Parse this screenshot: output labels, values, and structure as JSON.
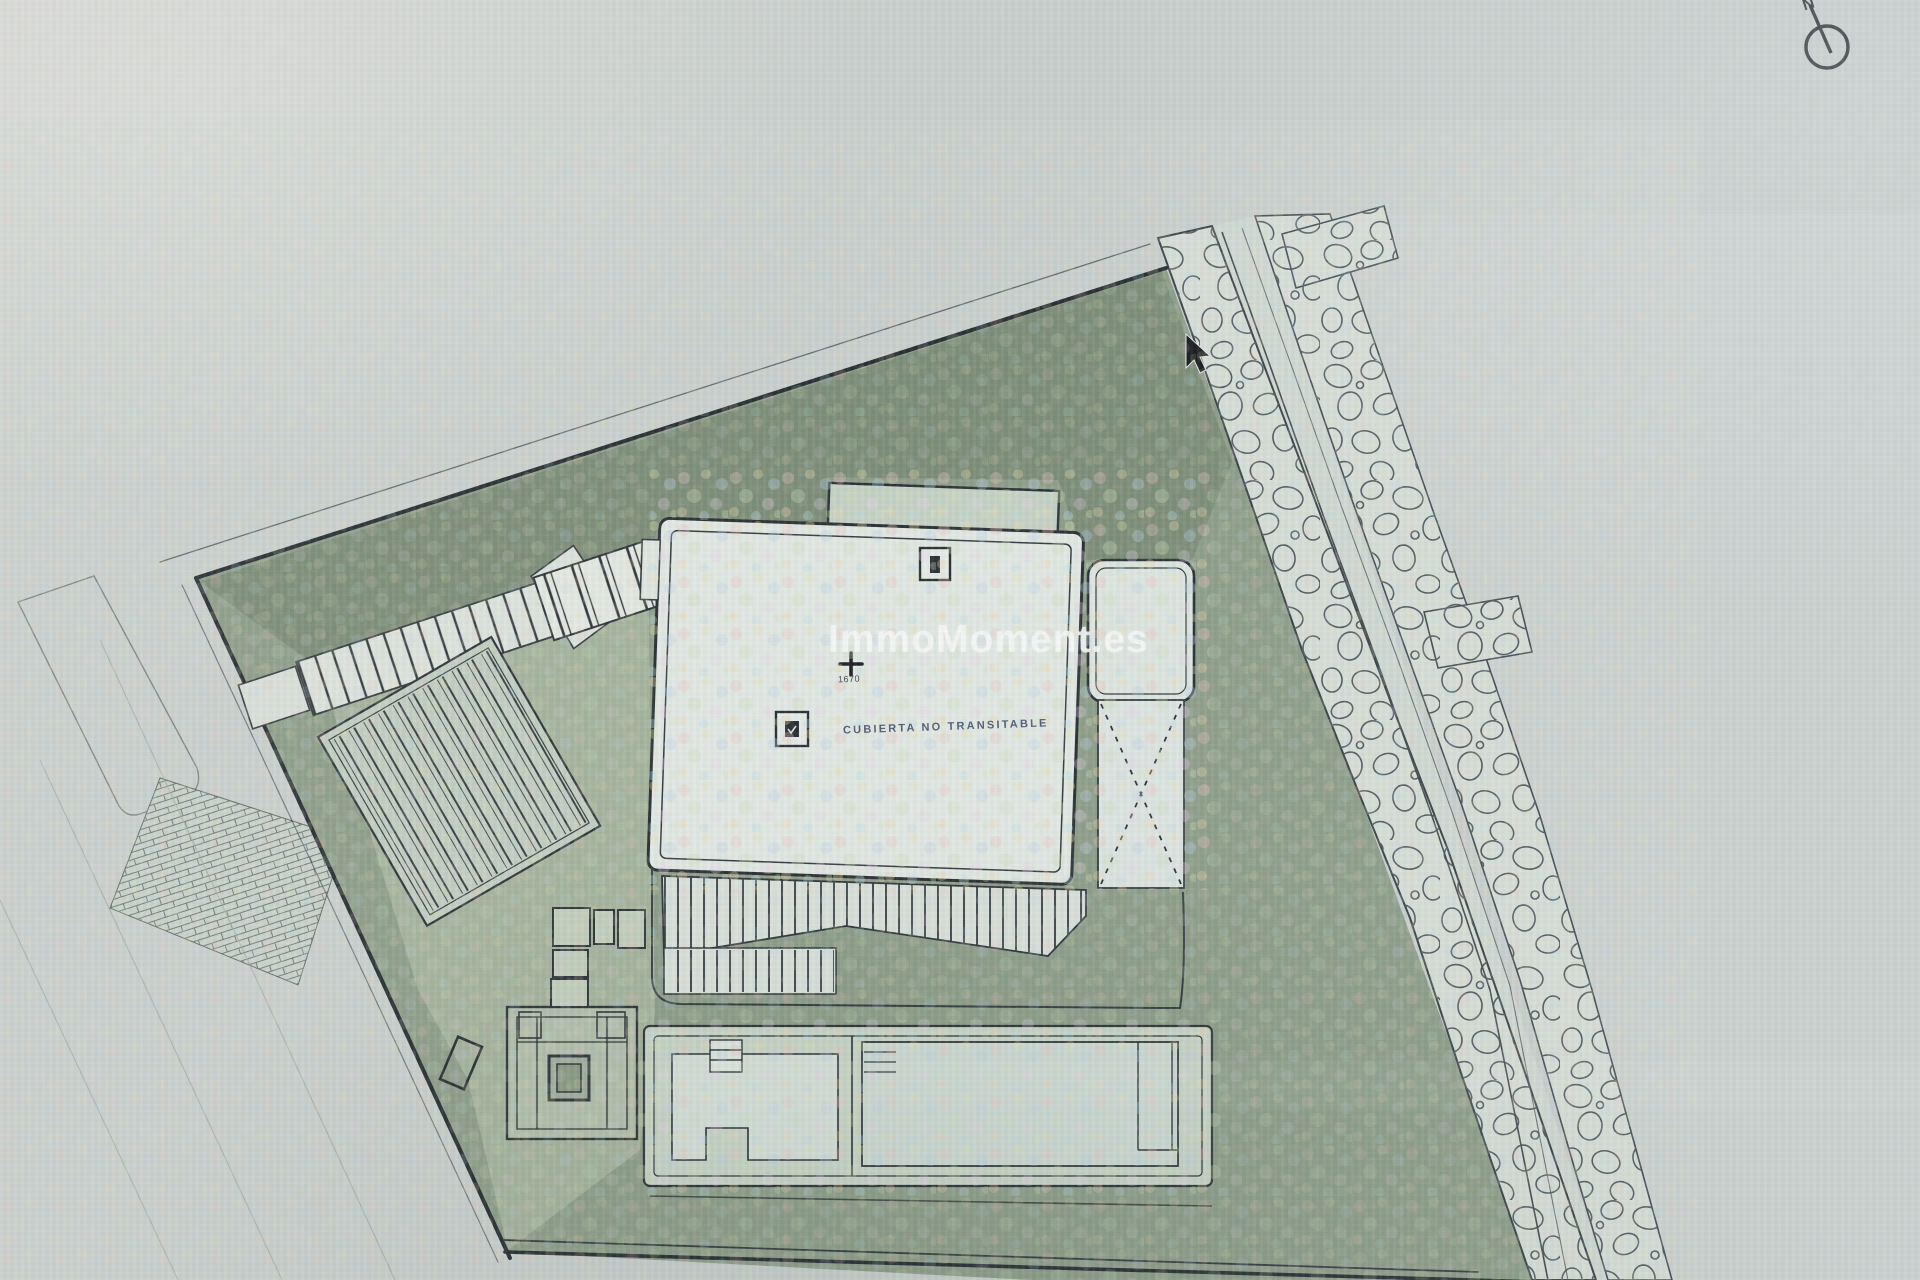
{
  "screen": {
    "description": "Photograph of a screen showing a CAD roof/site plan of a villa plot",
    "watermark": {
      "text": "ImmoMoment.es"
    },
    "plan": {
      "roof_label": "CUBIERTA NO TRANSITABLE",
      "level_marker": {
        "value": "1670"
      },
      "north_indicator": {
        "letter": "N"
      }
    },
    "icons": {
      "north_arrow": "circle-with-needle-pointing-up-left",
      "mouse_cursor": "black-arrow-pointer",
      "roof_vent": "small-square-with-dark-inset",
      "level_cross": "plus-cross-survey-marker"
    },
    "colors": {
      "plot_green": "#8a9b85",
      "dark_green_band": "#64785f",
      "light_paving": "#b7c4ac",
      "paper": "#ccd4cf",
      "background_gray": "#c7cdcb",
      "stone_fill": "#d8e0d8",
      "line_dark": "#22282c",
      "watermark_white": "#fafdfa"
    }
  }
}
